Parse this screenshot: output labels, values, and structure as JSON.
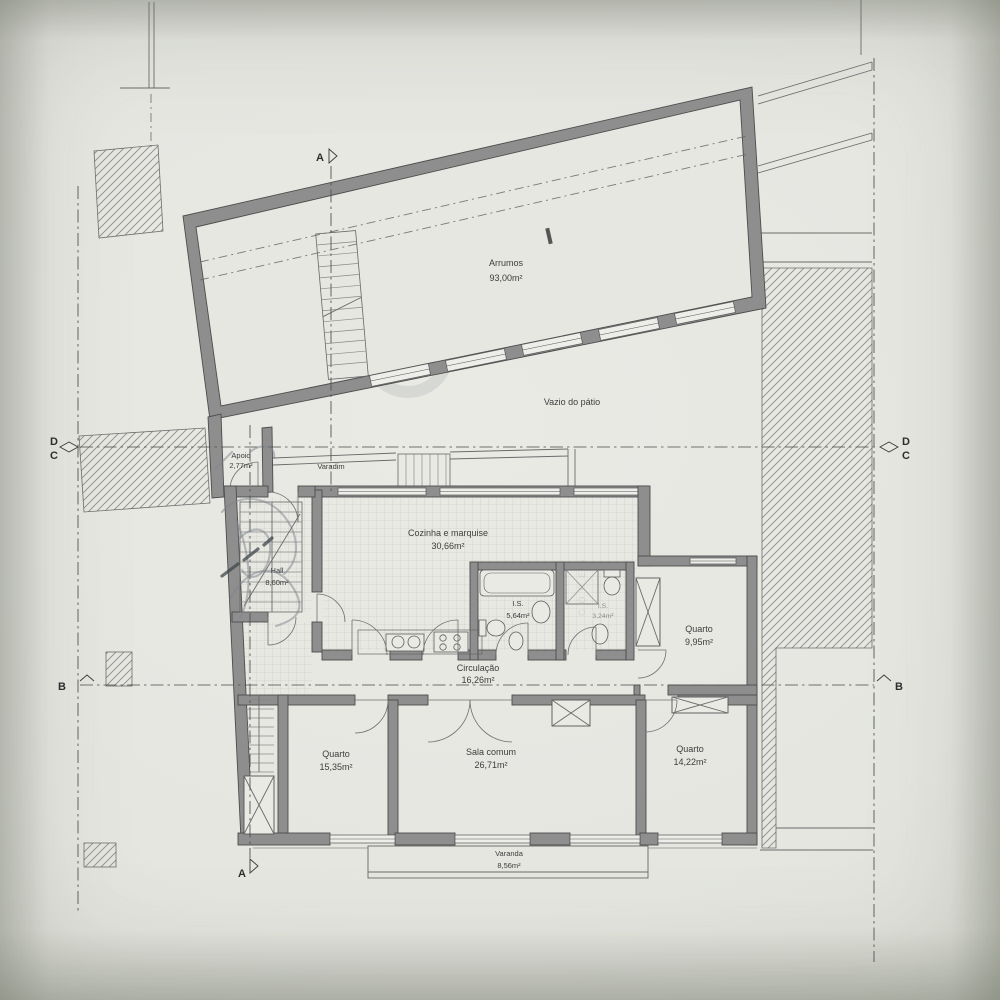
{
  "plan": {
    "rooms": {
      "arrumos": {
        "name": "Arrumos",
        "area": "93,00m²"
      },
      "vazio": {
        "name": "Vazio do pátio"
      },
      "apoio": {
        "name": "Apoio",
        "area": "2,77m²"
      },
      "varadim": {
        "name": "Varadim"
      },
      "cozinha": {
        "name": "Cozinha e marquise",
        "area": "30,66m²"
      },
      "hall": {
        "name": "Hall",
        "area": "8,60m²"
      },
      "is1": {
        "name": "I.S.",
        "area": "5,64m²"
      },
      "is2": {
        "name": "I.S.",
        "area": "3,24m²"
      },
      "quarto1": {
        "name": "Quarto",
        "area": "9,95m²"
      },
      "circulacao": {
        "name": "Circulação",
        "area": "16,26m²"
      },
      "quarto2": {
        "name": "Quarto",
        "area": "15,35m²"
      },
      "sala": {
        "name": "Sala comum",
        "area": "26,71m²"
      },
      "quarto3": {
        "name": "Quarto",
        "area": "14,22m²"
      },
      "varanda": {
        "name": "Varanda",
        "area": "8,56m²"
      }
    },
    "section_markers": {
      "a": "A",
      "b": "B",
      "c": "C",
      "d": "D"
    },
    "watermark": {
      "text": "CORES",
      "registered": "®"
    },
    "colors": {
      "paper": "#e6e7e1",
      "wall": "#8e8e8e",
      "line": "#4d4d4d"
    }
  }
}
